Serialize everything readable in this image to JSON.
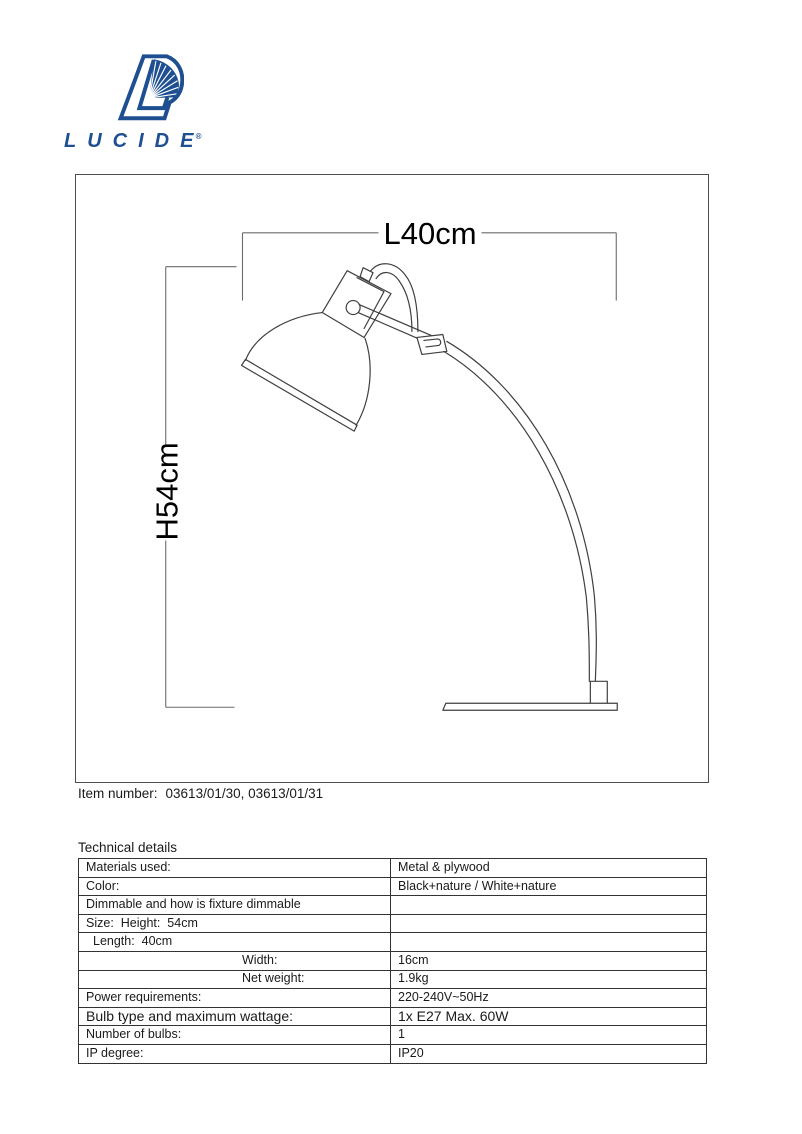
{
  "logo": {
    "brand": "LUCIDE",
    "registered": "®",
    "color": "#1d4f91"
  },
  "drawing": {
    "dim_length_label": "L40cm",
    "dim_height_label": "H54cm"
  },
  "item_number": {
    "label": "Item number:",
    "value": "03613/01/30, 03613/01/31"
  },
  "technical_details": {
    "title": "Technical details",
    "rows": [
      {
        "label": "Materials used:",
        "value": "Metal & plywood",
        "indent": "none",
        "emphasis": false
      },
      {
        "label": "Color:",
        "value": "Black+nature / White+nature",
        "indent": "none",
        "emphasis": false
      },
      {
        "label": "Dimmable and how is fixture dimmable",
        "value": "",
        "indent": "none",
        "emphasis": false
      },
      {
        "label": "Size:  Height:  54cm",
        "value": "",
        "indent": "none",
        "emphasis": false
      },
      {
        "label": "Length:  40cm",
        "value": "",
        "indent": "small",
        "emphasis": false
      },
      {
        "label": "Width:",
        "value": "16cm",
        "indent": "large",
        "emphasis": false
      },
      {
        "label": "Net weight:",
        "value": "1.9kg",
        "indent": "large",
        "emphasis": false
      },
      {
        "label": "Power requirements:",
        "value": "220-240V~50Hz",
        "indent": "none",
        "emphasis": false
      },
      {
        "label": "Bulb type and maximum wattage:",
        "value": "1x E27 Max. 60W",
        "indent": "none",
        "emphasis": true
      },
      {
        "label": "Number of bulbs:",
        "value": "1",
        "indent": "none",
        "emphasis": false
      },
      {
        "label": "IP degree:",
        "value": "IP20",
        "indent": "none",
        "emphasis": false
      }
    ]
  }
}
